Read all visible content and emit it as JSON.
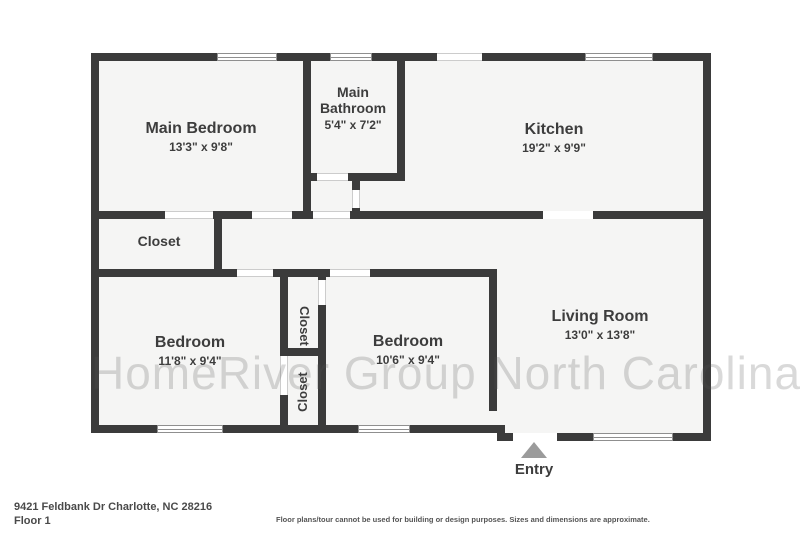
{
  "watermark": "HomeRiver Group North Carolina",
  "rooms": [
    {
      "name": "Main Bedroom",
      "dims": "13'3\" x 9'8\""
    },
    {
      "name": "Main Bathroom",
      "dims": "5'4\" x 7'2\""
    },
    {
      "name": "Kitchen",
      "dims": "19'2\" x 9'9\""
    },
    {
      "name": "Closet",
      "dims": ""
    },
    {
      "name": "Bedroom",
      "dims": "11'8\" x 9'4\""
    },
    {
      "name": "Closet",
      "dims": ""
    },
    {
      "name": "Closet",
      "dims": ""
    },
    {
      "name": "Bedroom",
      "dims": "10'6\" x 9'4\""
    },
    {
      "name": "Living Room",
      "dims": "13'0\" x 13'8\""
    }
  ],
  "entry_label": "Entry",
  "footer": {
    "address": "9421 Feldbank Dr Charlotte, NC 28216",
    "floor": "Floor 1",
    "disclaimer": "Floor plans/tour cannot be used for building or design purposes. Sizes and dimensions are approximate."
  },
  "colors": {
    "wall": "#3b3b3b",
    "floor": "#f5f5f4",
    "entry_arrow": "#9b9b9b"
  }
}
